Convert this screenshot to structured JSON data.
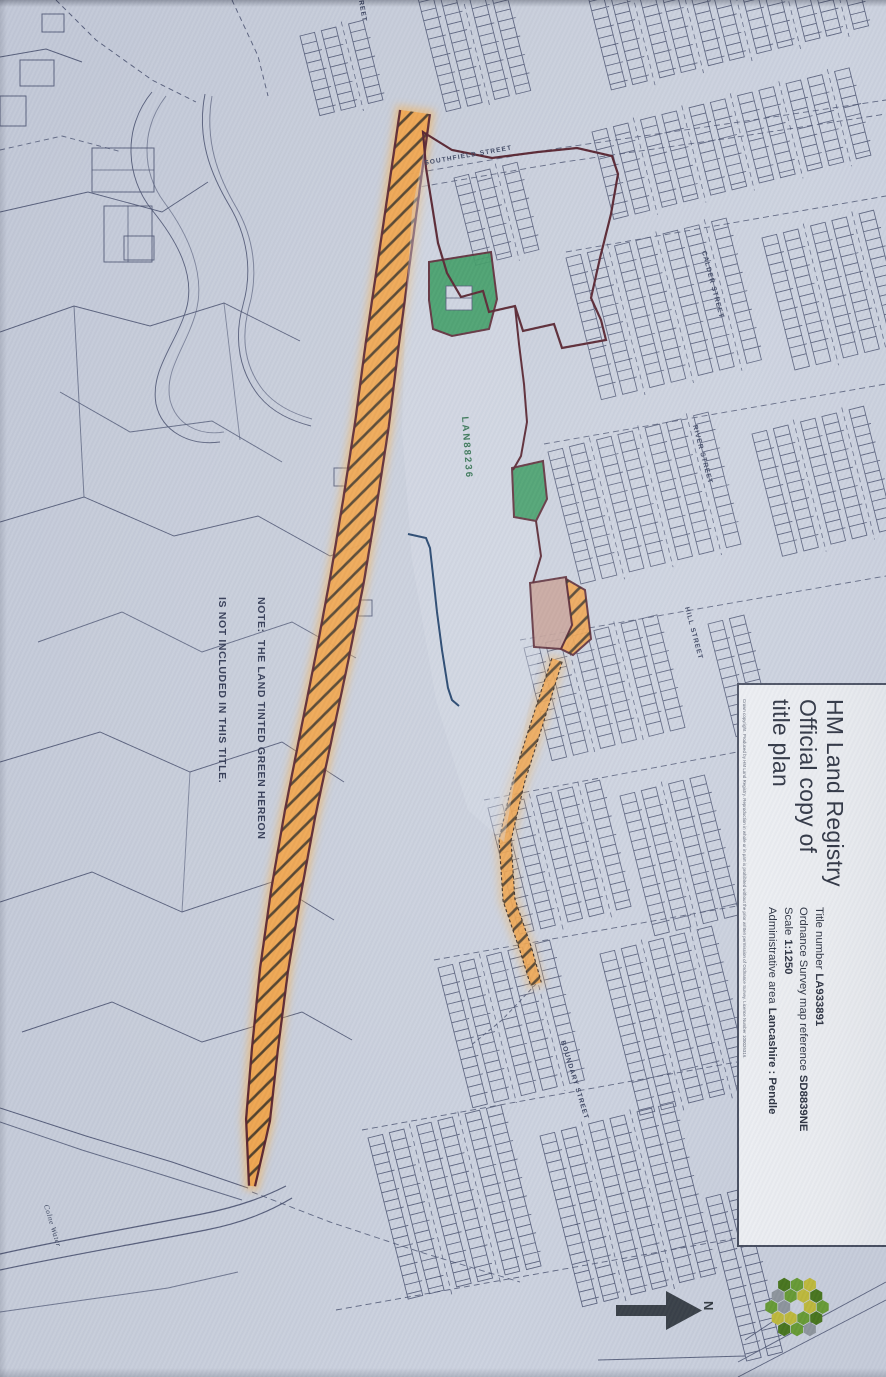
{
  "title_panel": {
    "heading_lines": [
      "HM Land Registry",
      "Official copy of",
      "title plan"
    ],
    "fields": [
      {
        "label": "Title number",
        "value": "LA933891"
      },
      {
        "label": "Ordnance Survey map reference",
        "value": "SD8839NE"
      },
      {
        "label": "Scale",
        "value": "1:1250"
      },
      {
        "label": "Administrative area",
        "value": "Lancashire : Pendle"
      }
    ],
    "copyright": "Crown copyright. Produced by HM Land Registry. Reproduction in whole or in part is prohibited without the prior written permission of Ordnance Survey. Licence Number 100026316."
  },
  "map": {
    "note_line1": "NOTE:  THE LAND TINTED GREEN HEREON",
    "note_line2": "IS NOT INCLUDED IN THIS TITLE.",
    "parcel_reference": "LAN88236",
    "north_label": "N",
    "streets": {
      "calder": "CALDER STREET",
      "river": "RIVER STREET",
      "hill": "HILL STREET",
      "boundary": "BOUNDARY STREET",
      "southfield": "SOUTHFIELD STREET",
      "partial_top": "REET"
    },
    "water": "Colne Water",
    "colors": {
      "band_orange": "#efa24b",
      "band_glow": "#ffae3d",
      "hatch": "#26241f",
      "boundary_red": "#54202c",
      "tint_green": "#3a9a62",
      "tint_pink": "#c6a096",
      "edge_blue": "#1e3f69",
      "ink": "#4a5270",
      "paper": "#ccd2df",
      "logo_green": "#679a35",
      "logo_dark_green": "#48751f",
      "logo_yellow": "#bdb83c",
      "logo_grey": "#8d949c",
      "arrow": "#3a4149"
    }
  },
  "logo_name": "HM Land Registry emblem"
}
